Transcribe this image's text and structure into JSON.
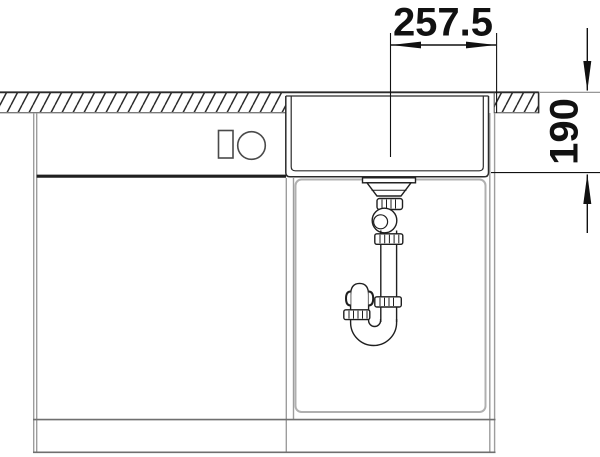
{
  "drawing": {
    "kind": "sink-cabinet-section-technical-drawing",
    "background": "#ffffff"
  },
  "dimensions": {
    "horizontal": {
      "value": "257.5",
      "orientation": "horizontal"
    },
    "vertical": {
      "value": "190",
      "orientation": "vertical-rotated"
    }
  },
  "colors": {
    "drawing_line": "#1f1f1f",
    "cabinet_line": "#9d9d9d",
    "interior_line": "#b0b0b0",
    "dimension": "#111111",
    "background": "#ffffff"
  }
}
